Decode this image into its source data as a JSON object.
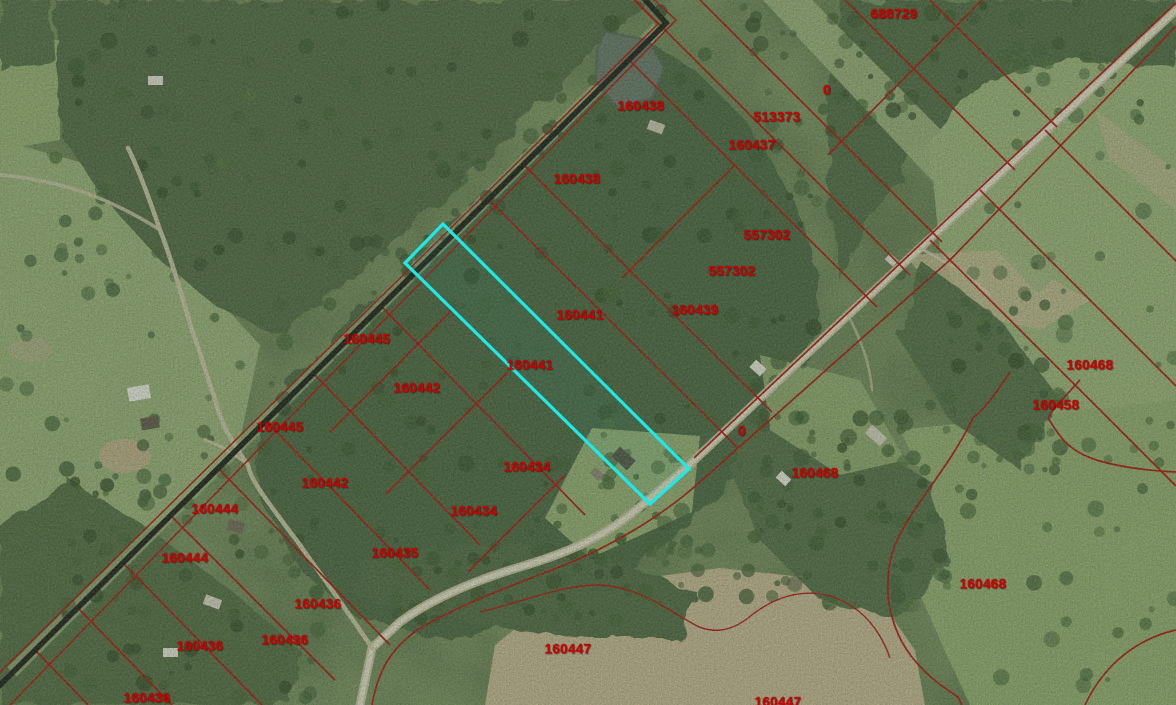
{
  "map": {
    "type": "aerial-parcel-map",
    "colors": {
      "parcel_line": "#b00000",
      "parcel_label": "#d40000",
      "highlight": "#1fe9e6",
      "railroad_line": "#0b0b0b"
    },
    "highlighted_parcel": {
      "label": "160441",
      "points": "443,224 405,263 650,504 689,469"
    },
    "parcel_labels": [
      {
        "text": "688729",
        "x": 894,
        "y": 14
      },
      {
        "text": "0",
        "x": 827,
        "y": 90
      },
      {
        "text": "160438",
        "x": 641,
        "y": 106
      },
      {
        "text": "513373",
        "x": 777,
        "y": 117
      },
      {
        "text": "160437",
        "x": 752,
        "y": 145
      },
      {
        "text": "160438",
        "x": 577,
        "y": 179
      },
      {
        "text": "557302",
        "x": 767,
        "y": 235
      },
      {
        "text": "557302",
        "x": 732,
        "y": 271
      },
      {
        "text": "160439",
        "x": 695,
        "y": 310
      },
      {
        "text": "160441",
        "x": 580,
        "y": 315
      },
      {
        "text": "160445",
        "x": 367,
        "y": 339
      },
      {
        "text": "160441",
        "x": 530,
        "y": 365
      },
      {
        "text": "160442",
        "x": 417,
        "y": 388
      },
      {
        "text": "160445",
        "x": 280,
        "y": 427
      },
      {
        "text": "0",
        "x": 742,
        "y": 431
      },
      {
        "text": "160434",
        "x": 527,
        "y": 467
      },
      {
        "text": "160468",
        "x": 815,
        "y": 473
      },
      {
        "text": "160442",
        "x": 325,
        "y": 483
      },
      {
        "text": "160434",
        "x": 474,
        "y": 511
      },
      {
        "text": "160444",
        "x": 215,
        "y": 509
      },
      {
        "text": "160435",
        "x": 395,
        "y": 553
      },
      {
        "text": "160444",
        "x": 185,
        "y": 558
      },
      {
        "text": "160436",
        "x": 318,
        "y": 604
      },
      {
        "text": "160436",
        "x": 285,
        "y": 640
      },
      {
        "text": "160436",
        "x": 200,
        "y": 646
      },
      {
        "text": "160447",
        "x": 568,
        "y": 649
      },
      {
        "text": "160436",
        "x": 147,
        "y": 698
      },
      {
        "text": "160447",
        "x": 778,
        "y": 702
      },
      {
        "text": "160468",
        "x": 1090,
        "y": 365
      },
      {
        "text": "160458",
        "x": 1056,
        "y": 405
      },
      {
        "text": "160468",
        "x": 983,
        "y": 584
      }
    ]
  }
}
